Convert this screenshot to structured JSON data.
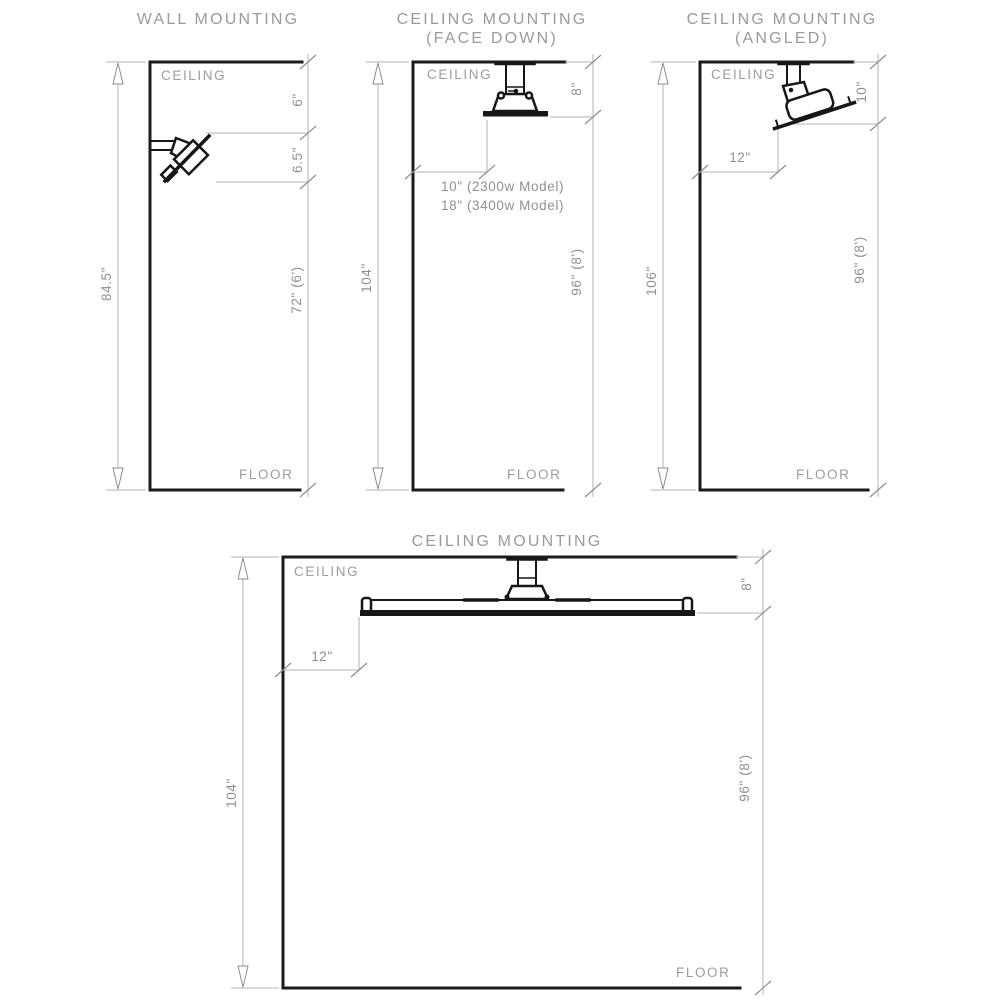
{
  "colors": {
    "wall_line": "#1b1b1b",
    "dimension_line": "#b3b3b3",
    "label_text": "#9a9a9a"
  },
  "wall_mounting": {
    "title": "WALL MOUNTING",
    "ceiling_label": "CEILING",
    "floor_label": "FLOOR",
    "total_height": "84.5\"",
    "ceiling_to_unit": "6\"",
    "unit_height": "6.5\"",
    "unit_to_floor": "72\" (6')"
  },
  "ceiling_face_down": {
    "title_line1": "CEILING MOUNTING",
    "title_line2": "(FACE DOWN)",
    "ceiling_label": "CEILING",
    "floor_label": "FLOOR",
    "total_height": "104\"",
    "ceiling_to_unit": "8\"",
    "wall_clearance_2300w": "10\" (2300w Model)",
    "wall_clearance_3400w": "18\" (3400w Model)",
    "unit_to_floor": "96\" (8')"
  },
  "ceiling_angled": {
    "title_line1": "CEILING MOUNTING",
    "title_line2": "(ANGLED)",
    "ceiling_label": "CEILING",
    "floor_label": "FLOOR",
    "total_height": "106\"",
    "ceiling_to_unit": "10\"",
    "wall_clearance": "12\"",
    "unit_to_floor": "96\" (8')"
  },
  "ceiling_panel": {
    "title": "CEILING MOUNTING",
    "ceiling_label": "CEILING",
    "floor_label": "FLOOR",
    "total_height": "104\"",
    "ceiling_to_unit": "8\"",
    "wall_clearance": "12\"",
    "unit_to_floor": "96\" (8')"
  }
}
